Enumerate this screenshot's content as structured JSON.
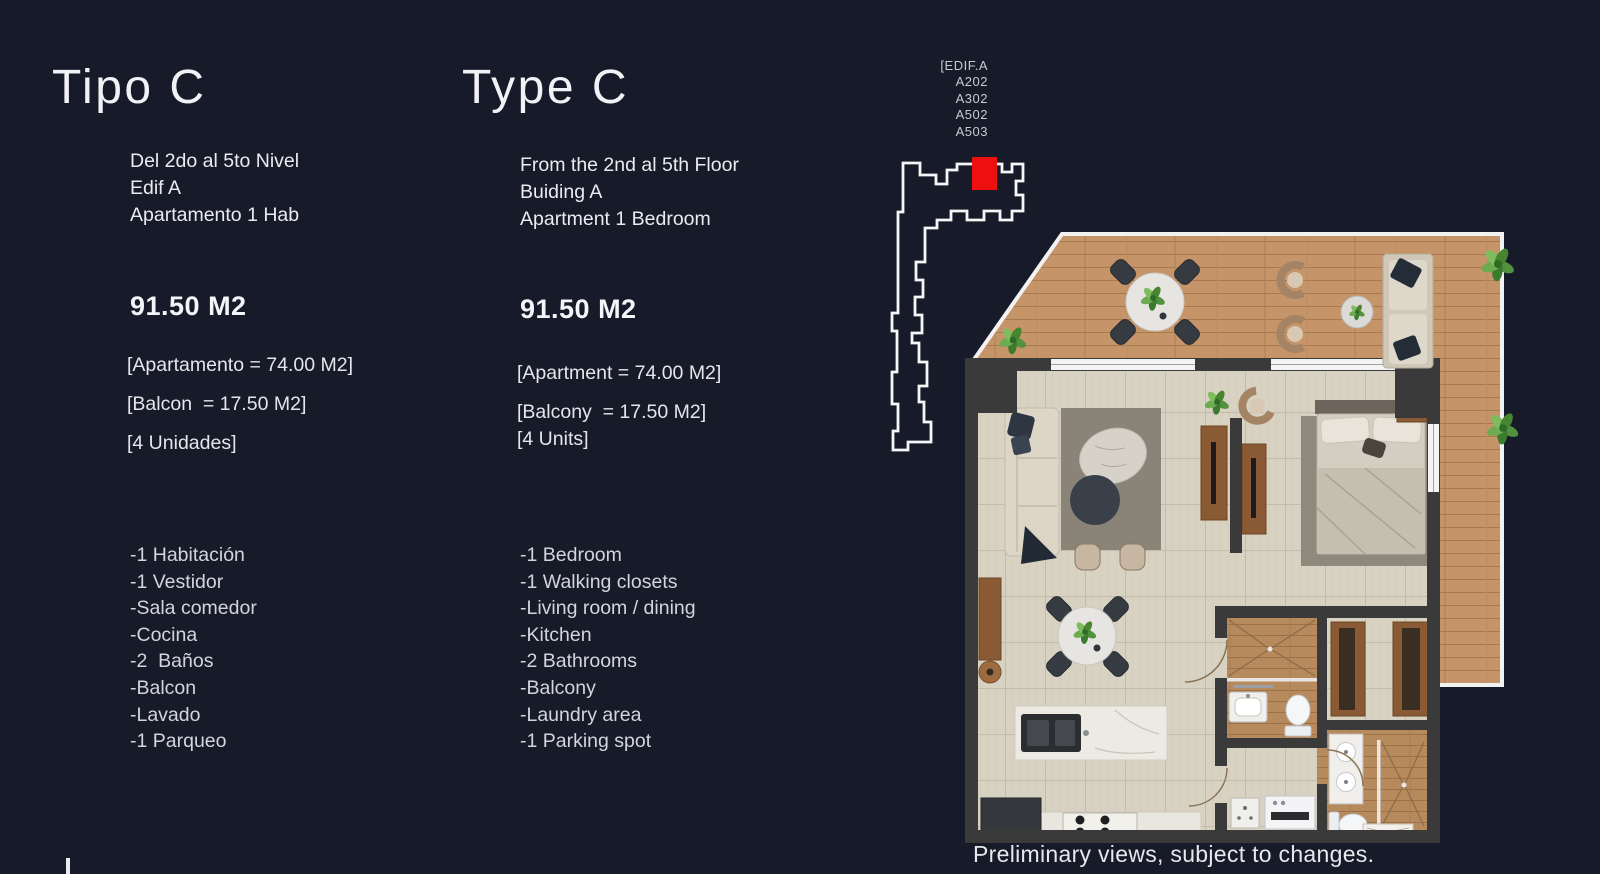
{
  "page": {
    "background": "#171a28",
    "caption": "Preliminary views, subject to changes."
  },
  "columns": {
    "spanish": {
      "title": "Tipo C",
      "subtitle_lines": [
        "Del 2do al 5to Nivel",
        "Edif A",
        "Apartamento 1 Hab"
      ],
      "area": "91.50 M2",
      "details": [
        "[Apartamento = 74.00 M2]",
        "[Balcon  = 17.50 M2]",
        "[4 Unidades]"
      ],
      "features": [
        "-1 Habitación",
        "-1 Vestidor",
        "-Sala comedor",
        "-Cocina",
        "-2  Baños",
        "-Balcon",
        "-Lavado",
        "-1 Parqueo"
      ]
    },
    "english": {
      "title": "Type C",
      "subtitle_lines": [
        "From the 2nd al 5th Floor",
        "Buiding A",
        "Apartment 1 Bedroom"
      ],
      "area": "91.50 M2",
      "details": [
        "[Apartment = 74.00 M2]",
        "[Balcony  = 17.50 M2]",
        "[4 Units]"
      ],
      "features": [
        "-1 Bedroom",
        "-1 Walking closets",
        "-Living room / dining",
        "-Kitchen",
        "-2 Bathrooms",
        "-Balcony",
        "-Laundry area",
        "-1 Parking spot"
      ]
    }
  },
  "building_locator": {
    "labels": [
      "[EDIF.A",
      "A202",
      "A302",
      "A502",
      "A503"
    ],
    "highlight_color": "#ee1010",
    "outline_color": "#f5f6f8"
  },
  "floor_plan": {
    "caption": "Preliminary views, subject to changes.",
    "colors": {
      "balcony_wood": "#c59469",
      "interior_tile": "#d8d2c3",
      "bath_wood": "#b78a5d",
      "walls": "#3b3a3a",
      "cabinet_brown": "#8a5a35",
      "plant_green": "#53923c"
    }
  }
}
